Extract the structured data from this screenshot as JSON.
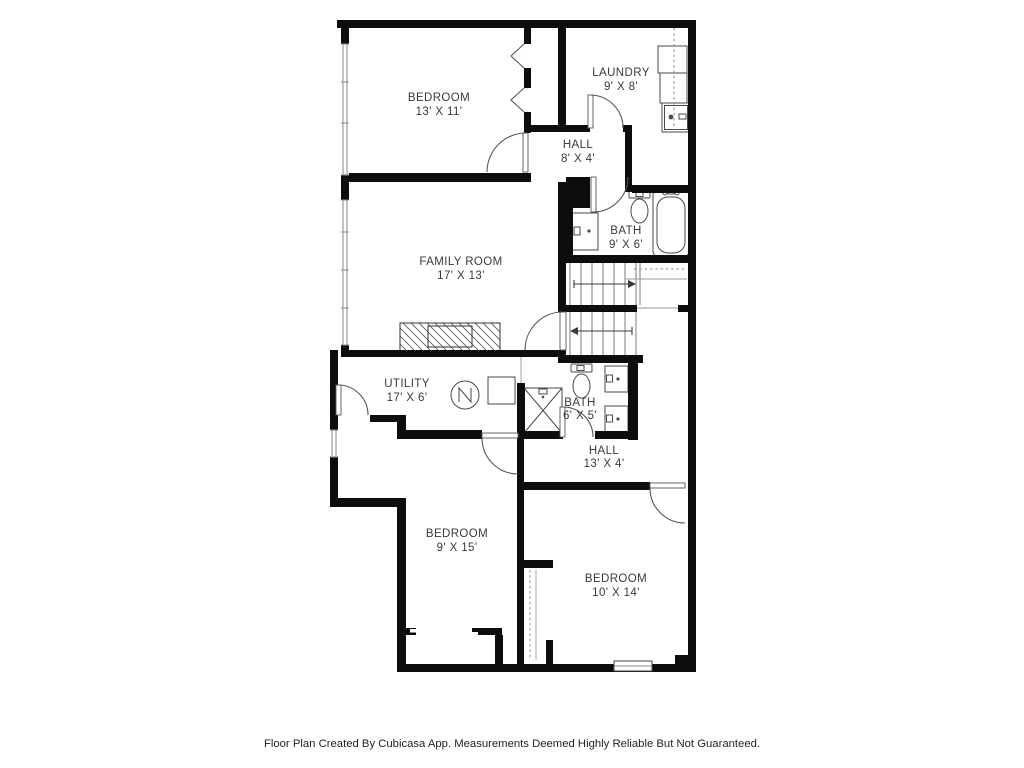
{
  "footer": {
    "text": "Floor Plan Created By Cubicasa App. Measurements Deemed Highly Reliable But Not Guaranteed."
  },
  "rooms": [
    {
      "id": "bedroom-upper",
      "name": "BEDROOM",
      "dims": "13' X 11'"
    },
    {
      "id": "laundry",
      "name": "LAUNDRY",
      "dims": "9' X 8'"
    },
    {
      "id": "hall-upper",
      "name": "HALL",
      "dims": "8' X 4'"
    },
    {
      "id": "bath-upper",
      "name": "BATH",
      "dims": "9' X 6'"
    },
    {
      "id": "family-room",
      "name": "FAMILY ROOM",
      "dims": "17' X 13'"
    },
    {
      "id": "utility",
      "name": "UTILITY",
      "dims": "17' X 6'"
    },
    {
      "id": "bath-lower",
      "name": "BATH",
      "dims": "6' X 5'"
    },
    {
      "id": "hall-lower",
      "name": "HALL",
      "dims": "13' X 4'"
    },
    {
      "id": "bedroom-left",
      "name": "BEDROOM",
      "dims": "9' X 15'"
    },
    {
      "id": "bedroom-right",
      "name": "BEDROOM",
      "dims": "10' X 14'"
    }
  ],
  "icons": [
    "window",
    "door-swing",
    "bifold-closet-door",
    "washer-dryer-stack",
    "laundry-counter",
    "bathtub",
    "toilet",
    "sink-vanity",
    "double-sink-vanity",
    "shower",
    "water-heater",
    "fireplace",
    "staircase",
    "stairs-direction-arrow",
    "closet-rod"
  ],
  "colors": {
    "wall": "#0d0d0d",
    "background": "#ffffff",
    "fixture": "#4a4a4a",
    "window": "#8a8a8a",
    "text": "#3a3a3a"
  }
}
